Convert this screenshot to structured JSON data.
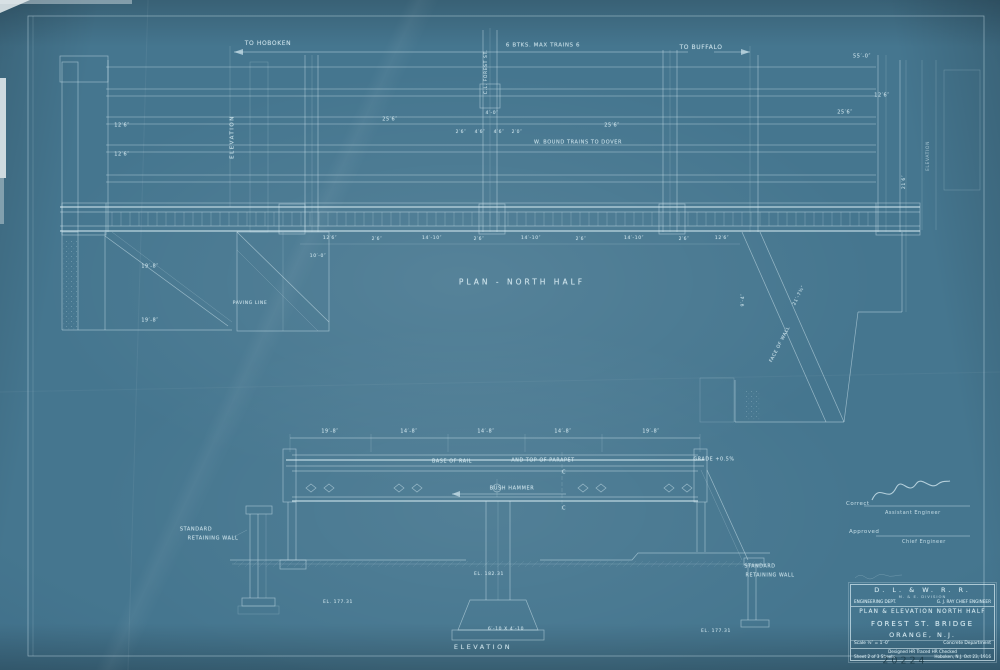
{
  "colors": {
    "paper": "#45768f",
    "paper_edge": "#2d5268",
    "ink": "#d9edf4",
    "pencil": "#16333f"
  },
  "plan": {
    "title": "PLAN - NORTH HALF"
  },
  "elevation": {
    "title": "ELEVATION",
    "left_vertical_label": "ELEVATION",
    "right_vertical_label": "ELEVATION"
  },
  "signature_block": {
    "correct_label": "Correct",
    "assistant_engineer": "Assistant Engineer",
    "approved_label": "Approved",
    "chief_engineer": "Chief Engineer"
  },
  "title_block": {
    "railroad": "D. L. & W. R. R.",
    "division": "M. & E. DIVISION",
    "engineering_dept": "ENGINEERING DEPT.",
    "chief_engineer": "G. J. RAY CHIEF ENGINEER",
    "title_line": "PLAN & ELEVATION  NORTH HALF",
    "bridge_name": "FOREST ST. BRIDGE",
    "location": "ORANGE, N.J.",
    "scale": "Scale ½″ = 1′-0″",
    "department": "Concrete Department",
    "credits": "Designed  HR      Traced  HR      Checked",
    "sheet": "Sheet 2 of 3 Sheets",
    "place_date": "Hoboken, N.J.   Oct 23, 1916"
  },
  "pencil_number": "20224",
  "annotations": [
    {
      "t": "To Hoboken",
      "x": 268,
      "y": 44,
      "s": 6,
      "n": "to-hoboken-label"
    },
    {
      "t": "6 Btks. Max Trains 6",
      "x": 543,
      "y": 46,
      "s": 5.5,
      "n": "max-trains-label"
    },
    {
      "t": "To Buffalo",
      "x": 701,
      "y": 48,
      "s": 6,
      "n": "to-buffalo-label"
    },
    {
      "t": "55′-0″",
      "x": 862,
      "y": 57,
      "s": 5
    },
    {
      "t": "C.L. Forest St.",
      "x": 487,
      "y": 72,
      "s": 4.5,
      "r": -90,
      "n": "street-centerline-label"
    },
    {
      "t": "12′6″",
      "x": 122,
      "y": 126,
      "s": 5
    },
    {
      "t": "12′6″",
      "x": 122,
      "y": 155,
      "s": 5
    },
    {
      "t": "25′6″",
      "x": 390,
      "y": 120,
      "s": 5
    },
    {
      "t": "4′-0″",
      "x": 492,
      "y": 114,
      "s": 4.5
    },
    {
      "t": "2′6″",
      "x": 461,
      "y": 133,
      "s": 4.5
    },
    {
      "t": "4′6″",
      "x": 480,
      "y": 133,
      "s": 4.5
    },
    {
      "t": "4′6″",
      "x": 499,
      "y": 133,
      "s": 4.5
    },
    {
      "t": "2′0″",
      "x": 517,
      "y": 133,
      "s": 4.5
    },
    {
      "t": "25′6″",
      "x": 612,
      "y": 126,
      "s": 5
    },
    {
      "t": "W. Bound Trains  To Dover",
      "x": 578,
      "y": 143,
      "s": 5,
      "n": "bound-trains-label"
    },
    {
      "t": "25′6″",
      "x": 845,
      "y": 113,
      "s": 5
    },
    {
      "t": "12′6″",
      "x": 882,
      "y": 96,
      "s": 5
    },
    {
      "t": "21′6″",
      "x": 905,
      "y": 182,
      "s": 4.5,
      "r": -90
    },
    {
      "t": "12′6″",
      "x": 330,
      "y": 239,
      "s": 4.5
    },
    {
      "t": "2′6″",
      "x": 377,
      "y": 240,
      "s": 4.5
    },
    {
      "t": "14′-10″",
      "x": 432,
      "y": 239,
      "s": 4.5
    },
    {
      "t": "2′6″",
      "x": 479,
      "y": 240,
      "s": 4.5
    },
    {
      "t": "14′-10″",
      "x": 531,
      "y": 239,
      "s": 4.5
    },
    {
      "t": "2′6″",
      "x": 581,
      "y": 240,
      "s": 4.5
    },
    {
      "t": "14′-10″",
      "x": 634,
      "y": 239,
      "s": 4.5
    },
    {
      "t": "2′6″",
      "x": 684,
      "y": 240,
      "s": 4.5
    },
    {
      "t": "12′6″",
      "x": 722,
      "y": 239,
      "s": 4.5
    },
    {
      "t": "19′-8″",
      "x": 150,
      "y": 268,
      "s": 4.8
    },
    {
      "t": "19′-8″",
      "x": 150,
      "y": 322,
      "s": 4.8
    },
    {
      "t": "Paving Line",
      "x": 250,
      "y": 304,
      "s": 4.5
    },
    {
      "t": "10′-0″",
      "x": 318,
      "y": 257,
      "s": 4.5
    },
    {
      "t": "21′-7¾″",
      "x": 800,
      "y": 296,
      "s": 4.5,
      "r": -63
    },
    {
      "t": "9′-4″",
      "x": 744,
      "y": 300,
      "s": 4.5,
      "r": -90
    },
    {
      "t": "Face of Wall",
      "x": 781,
      "y": 345,
      "s": 4.5,
      "r": -63
    },
    {
      "t": "19′-8″",
      "x": 330,
      "y": 433,
      "s": 4.8
    },
    {
      "t": "14′-8″",
      "x": 409,
      "y": 433,
      "s": 4.8
    },
    {
      "t": "14′-8″",
      "x": 486,
      "y": 433,
      "s": 4.8
    },
    {
      "t": "14′-8″",
      "x": 563,
      "y": 433,
      "s": 4.8
    },
    {
      "t": "19′-8″",
      "x": 651,
      "y": 433,
      "s": 4.8
    },
    {
      "t": "Base of Rail",
      "x": 452,
      "y": 463,
      "s": 4.8,
      "n": "base-of-rail-label"
    },
    {
      "t": "and Top of Parapet",
      "x": 543,
      "y": 462,
      "s": 4.8,
      "n": "top-of-parapet-label"
    },
    {
      "t": "Grade +0.5%",
      "x": 714,
      "y": 461,
      "s": 4.8,
      "n": "grade-label"
    },
    {
      "t": "C",
      "x": 564,
      "y": 473,
      "s": 5
    },
    {
      "t": "C",
      "x": 564,
      "y": 509,
      "s": 5
    },
    {
      "t": "Bush Hammer",
      "x": 512,
      "y": 489,
      "s": 5,
      "n": "bush-hammer-label"
    },
    {
      "t": "Standard",
      "x": 196,
      "y": 530,
      "s": 5
    },
    {
      "t": "Retaining Wall",
      "x": 213,
      "y": 539,
      "s": 5
    },
    {
      "t": "Standard",
      "x": 760,
      "y": 568,
      "s": 4.8
    },
    {
      "t": "Retaining Wall",
      "x": 770,
      "y": 577,
      "s": 4.8
    },
    {
      "t": "El. 182.31",
      "x": 489,
      "y": 575,
      "s": 4.5
    },
    {
      "t": "6′-10 x 4′-10",
      "x": 506,
      "y": 630,
      "s": 4.5
    },
    {
      "t": "El. 177.31",
      "x": 338,
      "y": 603,
      "s": 4.5
    },
    {
      "t": "El. 177.31",
      "x": 716,
      "y": 632,
      "s": 4.5
    }
  ]
}
